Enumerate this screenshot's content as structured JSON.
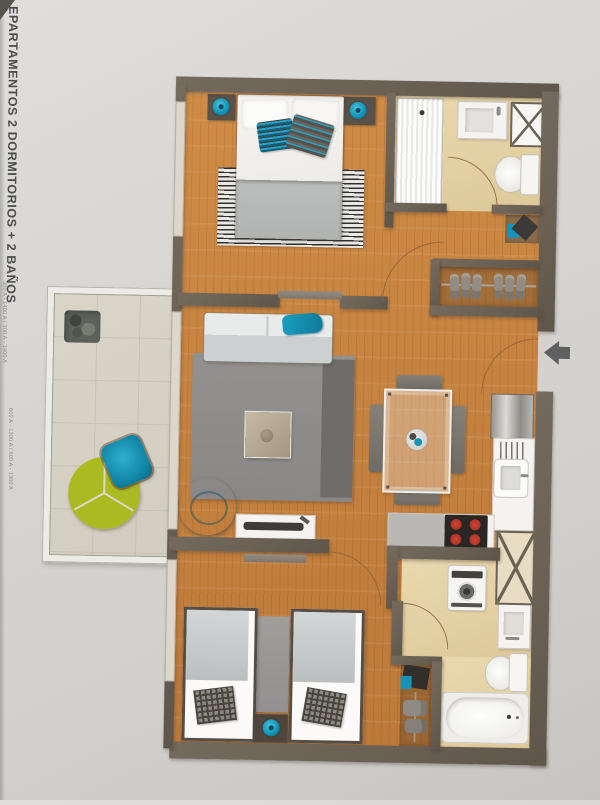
{
  "photo": {
    "margin_title": "EPARTAMENTOS 2 DORMITORIOS + 2 BAÑOS",
    "margin_code_1": "300 A - 1400 A / 300 A - 1400 A",
    "margin_code_2": "600 A - 1300 A / 600 A - 1300 A"
  },
  "floorplan": {
    "entrance_arrow_direction": "left"
  },
  "colors": {
    "paper": "#d7d5d3",
    "wall": "#6e6458",
    "wood_floor": "#c5813f",
    "bath_floor": "#e5d2a7",
    "balcony_floor": "#d5d0c4",
    "teal_accent": "#1a9dbd",
    "sofa_gray": "#ccd0d1",
    "rug_gray": "#8e8c8a",
    "burner_red": "#c63a2a",
    "arrow_gray": "#5f5f5f"
  }
}
